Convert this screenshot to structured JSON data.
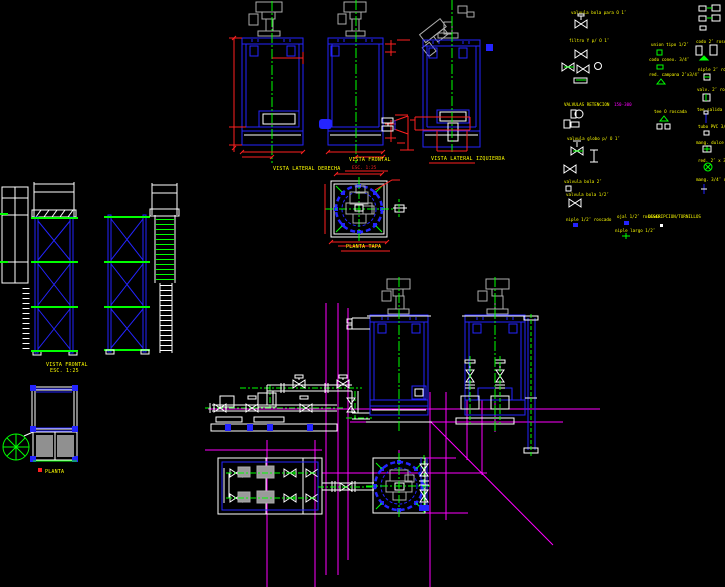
{
  "drawing": {
    "type": "cad-model-space",
    "background": "#000000",
    "colors": {
      "outline_blue": "#2424FF",
      "centerline_green": "#00FF00",
      "dimension_red": "#FF2020",
      "label_yellow": "#FFFF00",
      "reference_magenta": "#FF00FF",
      "equipment_gray": "#ADADAD",
      "linework_white": "#FFFFFF"
    }
  },
  "captions": {
    "tank1": "VISTA LATERAL DERECHA",
    "tank2_title": "VISTA FRONTAL",
    "tank2_scale": "ESC. 1:25",
    "tank3_title": "VISTA LATERAL IZQUIERDA",
    "flange_plan": "PLANTA TAPA",
    "platform_front_title": "VISTA FRONTAL",
    "platform_front_scale": "ESC. 1:25",
    "platform_plan": "PLANTA"
  },
  "legend": {
    "header": "VALVULAS RETENCION",
    "header_code": "150-300",
    "items": [
      {
        "label": "valvula bola para O 1″"
      },
      {
        "label": "filtro Y p/ O 1″"
      },
      {
        "label": "valvula globo p/ O 1″"
      },
      {
        "label": "valvula bola 2″"
      },
      {
        "label": "valvula bola 1/2″"
      },
      {
        "label": "niple 1/2″ roscado"
      },
      {
        "label": "union tipo 1/2″"
      },
      {
        "label": "codo conex. 3/4″"
      },
      {
        "label": "red. campana 2″x3/4″"
      },
      {
        "label": "tee O roscada"
      },
      {
        "label": "ojal 1/2″ roscado"
      },
      {
        "label": "niple largo 1/2″"
      },
      {
        "label": "DESCRIPCION/TORNILLOS"
      },
      {
        "label": "codo 2″ roscado"
      },
      {
        "label": "niple 2″ roscado"
      },
      {
        "label": "valv. 2″ roscada"
      },
      {
        "label": "tee salida p/ O"
      },
      {
        "label": "tubo PVC 3/4″"
      },
      {
        "label": "mang. dulce p/ O"
      },
      {
        "label": "red. 2″ x 3/4″"
      },
      {
        "label": "mang. 3/4″ dulce"
      }
    ]
  }
}
